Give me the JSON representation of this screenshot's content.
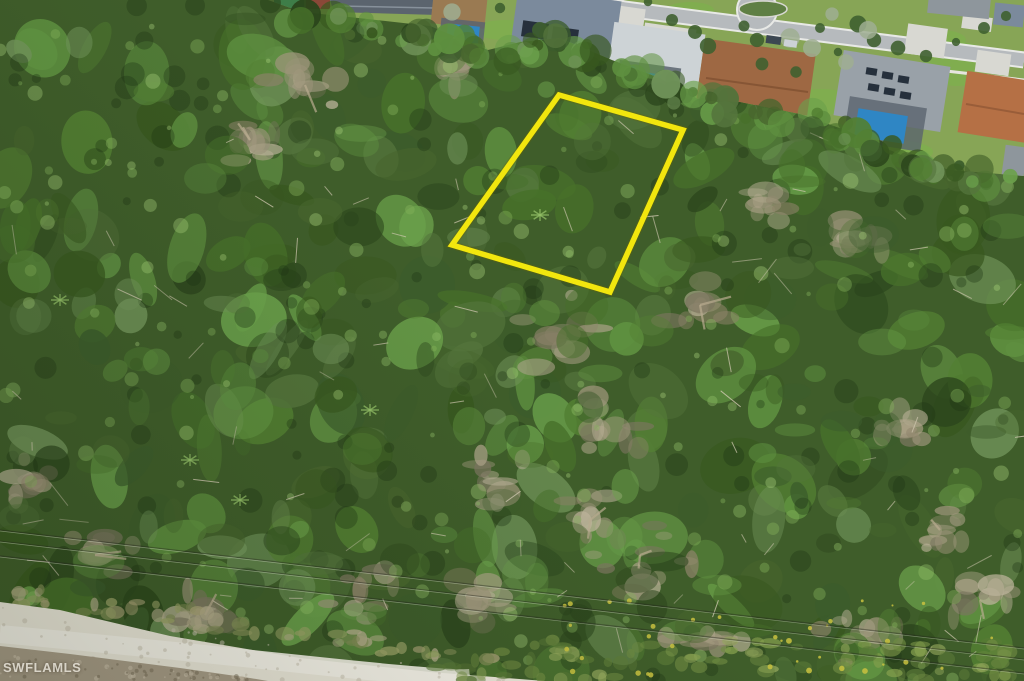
{
  "meta": {
    "kind": "aerial-drone-photograph",
    "subject": "Wooded vacant land parcel outlined in yellow beside a suburban neighborhood",
    "width": 1024,
    "height": 681
  },
  "watermark": {
    "text": "SWFLAMLS"
  },
  "parcel_overlay": {
    "color": "#f2e60e",
    "shadow_color": "#6b6200",
    "vertices": [
      [
        559,
        95
      ],
      [
        683,
        130
      ],
      [
        610,
        292
      ],
      [
        452,
        245
      ]
    ]
  },
  "features": {
    "forest": "dense mixed tree canopy covering most of the frame",
    "neighborhood": "single-family homes with screened pools along a street at the top edge",
    "dirt_road": "white sandy road crossing the bottom-left corner",
    "power_lines": "overhead utility wires crossing the lower third"
  },
  "palette": {
    "forest_base": "#3f5d2a",
    "forest_greens": [
      "#2b451c",
      "#38581f",
      "#47702a",
      "#538033",
      "#5f9140",
      "#6ba14b",
      "#54743c",
      "#48662e",
      "#71945a",
      "#3c5c2c"
    ],
    "forest_dark": "#1e3314",
    "forest_light": [
      "#86b35c",
      "#94c068",
      "#a5ce77"
    ],
    "dry": [
      "#9c947a",
      "#ada389",
      "#8c8268",
      "#bdb49b",
      "#7b755f"
    ],
    "trunk": "#d3cab3",
    "log": "#b9ac90",
    "sand": "#ebe7da",
    "sand_light": "#f5f2e9",
    "sand_speckle": "#c6bfae",
    "scrub": "#a89c88",
    "scrub_dark": "#786e5a",
    "scrub_light": "#cfc5b0",
    "transition": [
      "#98a066",
      "#b2aa8a",
      "#7f8a55",
      "#a8a176"
    ],
    "bottom_olive": [
      "#6f8a42",
      "#86a04e",
      "#5c7a38",
      "#93a75c"
    ],
    "flower_yellow": "#c9c240",
    "lawn": "#87a556",
    "lawn_bright": "#7fae4f",
    "road": "#b6babd",
    "curb": "#e8e9e6",
    "sidewalk": "#e6e5df",
    "driveway": "#d8d8d2",
    "pool": "#2f86c4",
    "pool_umbrella": "#3a76d2",
    "screen_enclosure": "#5a646e",
    "solar_panel": "#26303c",
    "roof_blue_gray": "#7b8a9c",
    "roof_light": "#cdd3d6",
    "roof_brown": "#9e6843",
    "roof_brown_ridge": "#7c4e2f",
    "roof_gray": "#99a1a8",
    "roof_terracotta": "#b57045",
    "roof_terracotta_ridge": "#8e5634",
    "roof_dark_gray": "#5b646e",
    "roof_tan": "#9a7a52",
    "roof_right_gray": "#8e969c",
    "court_green": "#3e7d48",
    "structure_red": "#8a4838",
    "shrub": "#3f6030",
    "shrub_silver": "#9fae92",
    "car_dark": "#3c4752",
    "car_light": "#cdd2d6",
    "median_island": "#5f7f44",
    "wire_dark": "rgba(35,38,28,0.42)",
    "wire_light": "rgba(228,232,216,0.40)"
  }
}
